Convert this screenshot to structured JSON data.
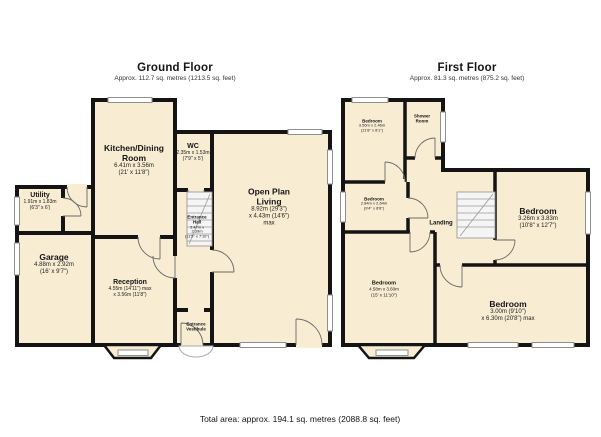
{
  "ground_floor": {
    "title": "Ground Floor",
    "subtitle": "Approx. 112.7 sq. metres (1213.5 sq. feet)",
    "rooms": {
      "kitchen": {
        "name": "Kitchen/Dining Room",
        "metric": "6.41m x 3.56m",
        "imperial": "(21' x 11'8\")"
      },
      "wc": {
        "name": "WC",
        "metric": "2.35m x 1.53m",
        "imperial": "(7'9\" x 5')"
      },
      "open_plan": {
        "name": "Open Plan Living",
        "metric": "8.92m (29'3\")",
        "imperial": "x 4.43m (14'6\") max"
      },
      "utility": {
        "name": "Utility",
        "metric": "1.91m x 1.83m",
        "imperial": "(6'3\" x 6')"
      },
      "garage": {
        "name": "Garage",
        "metric": "4.88m x 2.92m",
        "imperial": "(16' x 9'7\")"
      },
      "reception": {
        "name": "Reception",
        "metric": "4.55m (14'11\") max",
        "imperial": "x 3.56m (11'8\")"
      },
      "entrance_hall": {
        "name": "Entrance Hall",
        "metric": "3.47m x 2.39m",
        "imperial": "(11'5\" x 7'10\")"
      },
      "entrance_vestibule": {
        "name": "Entrance Vestibule"
      }
    }
  },
  "first_floor": {
    "title": "First Floor",
    "subtitle": "Approx. 81.3 sq. metres (875.2 sq. feet)",
    "rooms": {
      "bedroom_front": {
        "name": "Bedroom",
        "metric": "3.56m x 2.46m",
        "imperial": "(11'8\" x 8'1\")"
      },
      "shower_room": {
        "name": "Shower Room"
      },
      "bedroom_mid": {
        "name": "Bedroom",
        "metric": "2.84m x 2.64m",
        "imperial": "(9'4\" x 8'8\")"
      },
      "landing": {
        "name": "Landing"
      },
      "bedroom_right": {
        "name": "Bedroom",
        "metric": "3.26m x 3.83m",
        "imperial": "(10'8\" x 12'7\")"
      },
      "bedroom_bay": {
        "name": "Bedroom",
        "metric": "4.58m x 3.60m",
        "imperial": "(15' x 11'10\")"
      },
      "bedroom_rear": {
        "name": "Bedroom",
        "metric": "3.00m (9'10\")",
        "imperial": "x 6.30m (20'8\") max"
      }
    }
  },
  "footer": {
    "total_area": "Total area: approx. 194.1 sq. metres (2088.8 sq. feet)"
  },
  "colors": {
    "room_fill": "#f8ecd2",
    "wall": "#141414",
    "window_frame": "#8f8f8f"
  }
}
